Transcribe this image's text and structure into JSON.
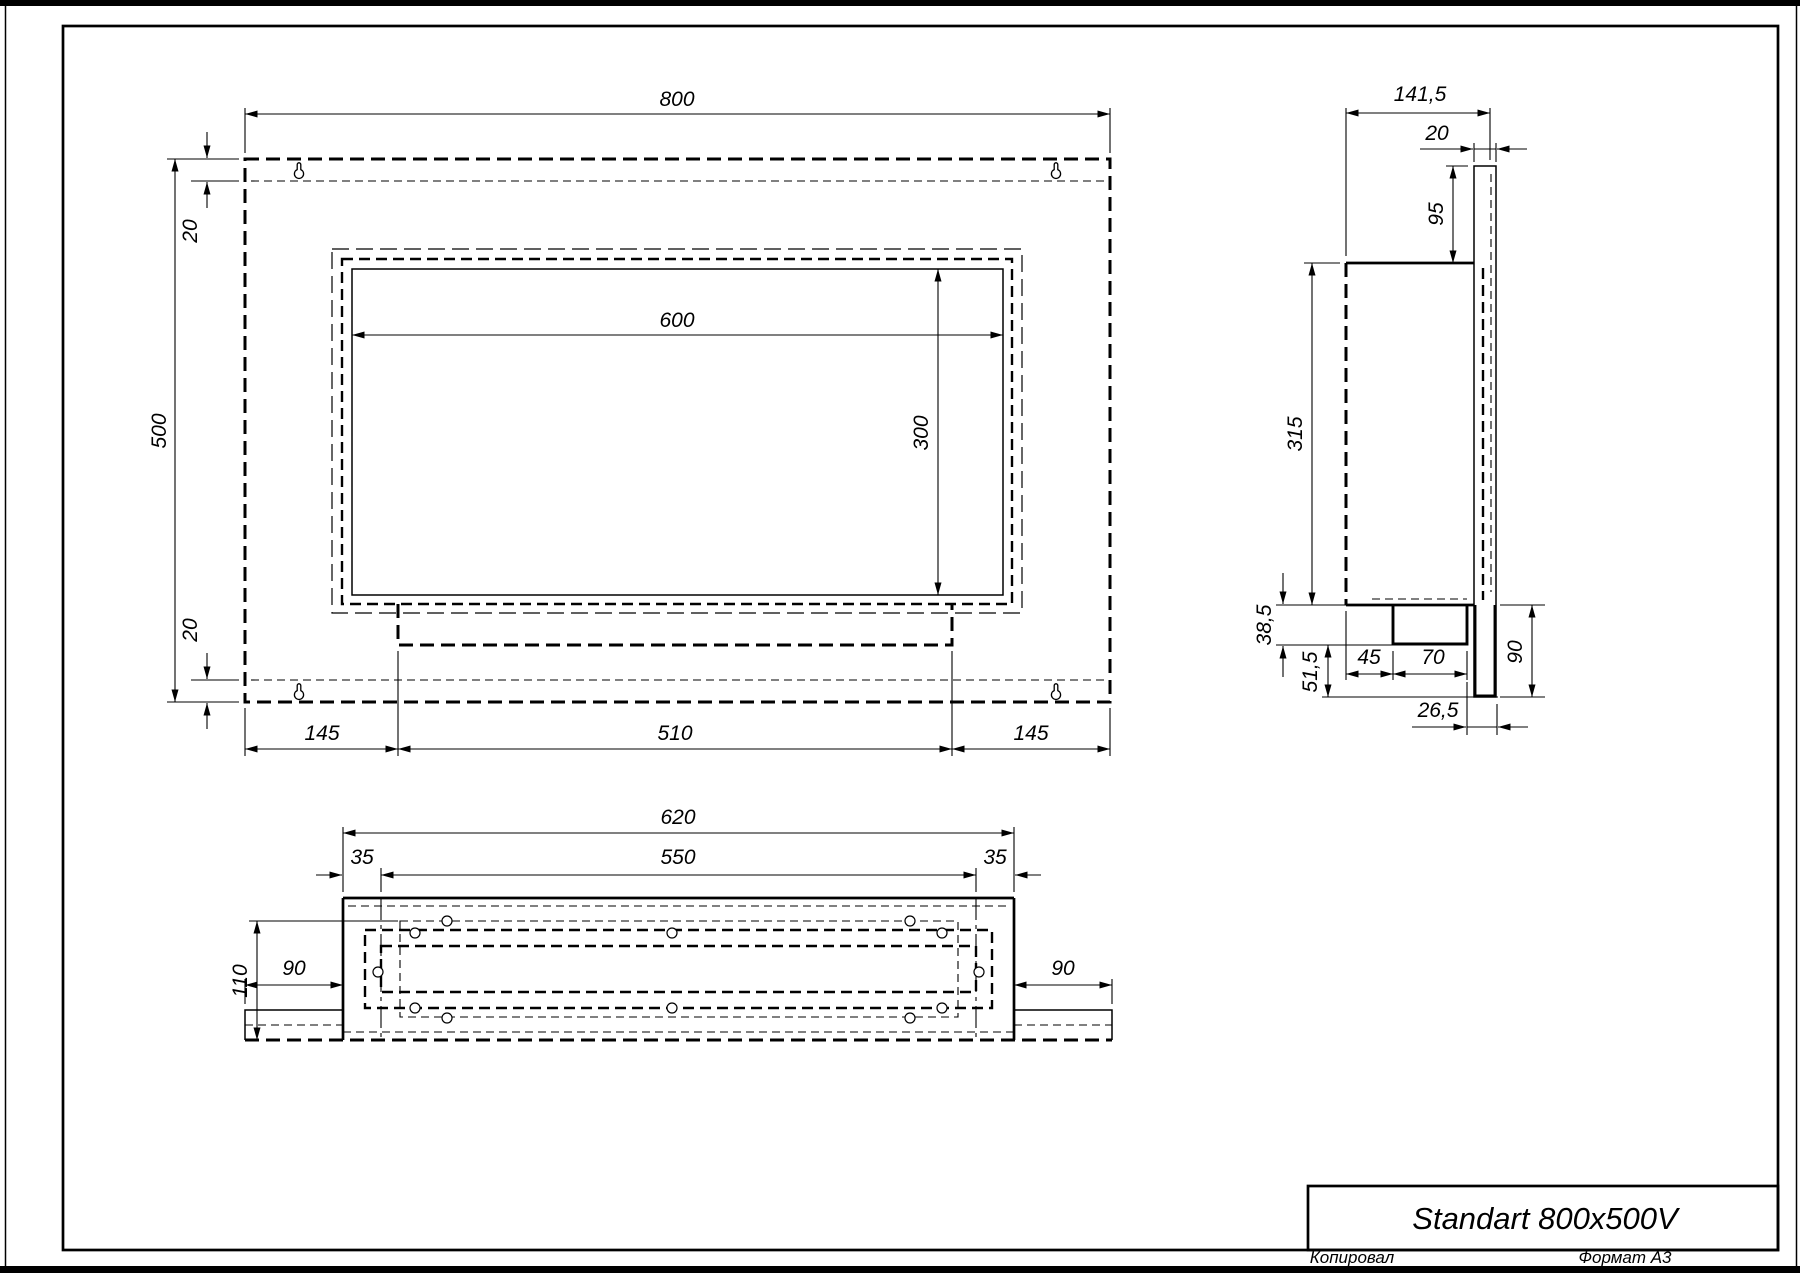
{
  "page": {
    "paper_color": "#ffffff",
    "ink_color": "#000000",
    "title_block": {
      "title": "Standart 800x500V"
    },
    "footer": {
      "copied": "Копировал",
      "format": "Формат А3"
    }
  },
  "front_view": {
    "dims": {
      "overall_width": "800",
      "overall_height": "500",
      "top_margin": "20",
      "bottom_margin": "20",
      "opening_width": "600",
      "opening_height": "300",
      "left_offset": "145",
      "tray_width": "510",
      "right_offset": "145"
    }
  },
  "side_view": {
    "dims": {
      "overall_depth": "141,5",
      "plate_depth": "20",
      "plate_above_body": "95",
      "body_height": "315",
      "below_body": "38,5",
      "lower_drop": "51,5",
      "tank_front_offset": "45",
      "tank_depth": "70",
      "back_gap": "26,5",
      "plate_below_body": "90"
    }
  },
  "bottom_view": {
    "dims": {
      "overall_width": "620",
      "inner_width": "550",
      "left_inset": "35",
      "right_inset": "35",
      "depth": "110",
      "left_wing": "90",
      "right_wing": "90"
    }
  }
}
